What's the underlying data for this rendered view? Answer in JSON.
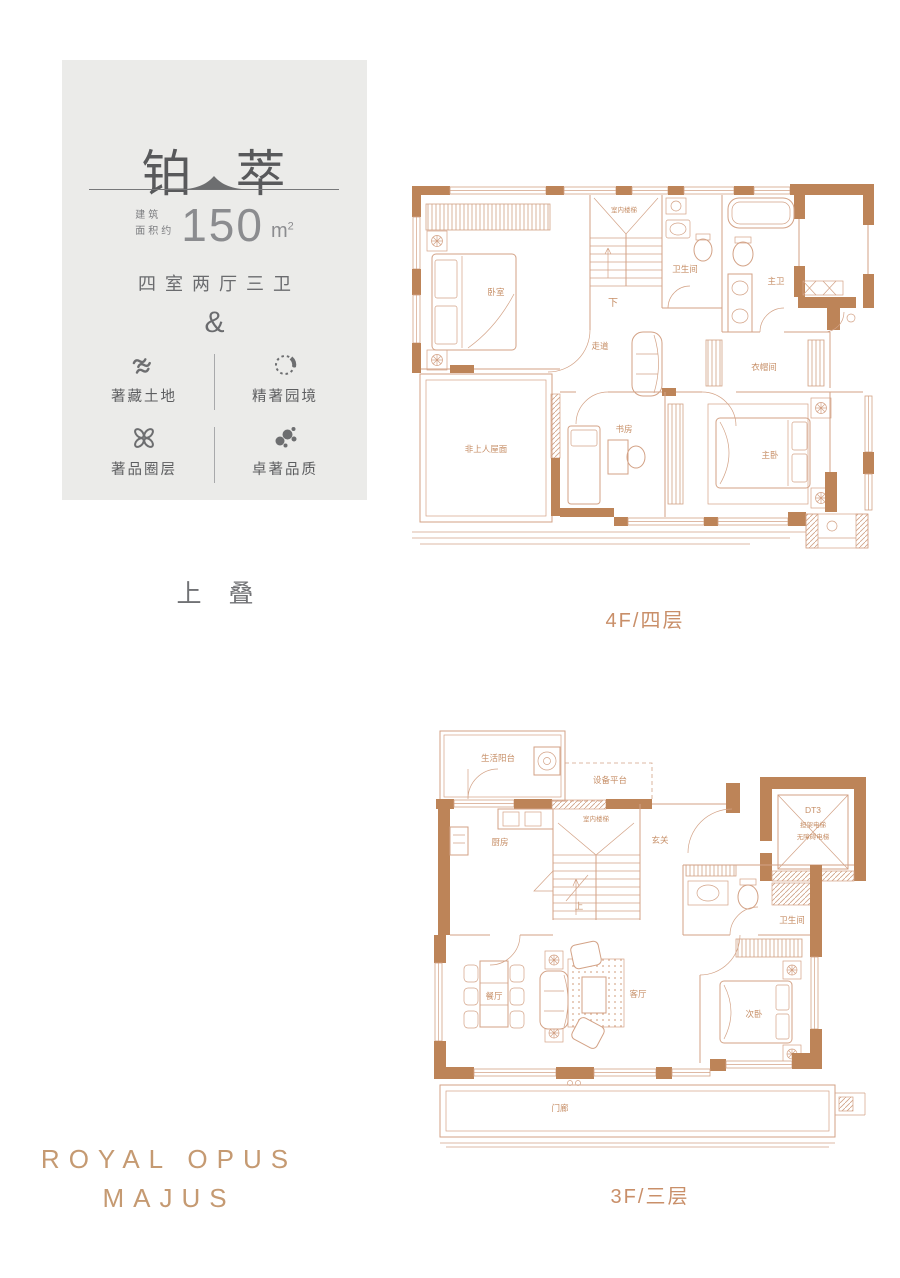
{
  "card": {
    "title": "铂 萃",
    "area_label_line1": "建筑",
    "area_label_line2": "面积约",
    "area_value": "150",
    "area_unit_base": "m",
    "area_unit_sup": "2",
    "layout": "四室两厅三卫",
    "ampersand": "&",
    "features": [
      {
        "icon": "land-waves-icon",
        "label": "著藏土地"
      },
      {
        "icon": "garden-circle-icon",
        "label": "精著园境"
      },
      {
        "icon": "knot-icon",
        "label": "著品圈层"
      },
      {
        "icon": "quality-dots-icon",
        "label": "卓著品质"
      }
    ]
  },
  "stack_label": "上 叠",
  "floor4": {
    "label": "4F/四层",
    "rooms": {
      "bedroom": "卧室",
      "stairs": "室内楼梯",
      "down": "下",
      "bath": "卫生间",
      "master_bath": "主卫",
      "corridor": "走道",
      "cloakroom": "衣帽间",
      "roof": "非上人屋面",
      "study": "书房",
      "master_bedroom": "主卧"
    }
  },
  "floor3": {
    "label": "3F/三层",
    "rooms": {
      "balcony": "生活阳台",
      "equipment": "设备平台",
      "stairs": "室内楼梯",
      "up": "上",
      "kitchen": "厨房",
      "foyer": "玄关",
      "elevator": "DT3",
      "elevator_note1": "担架电梯",
      "elevator_note2": "无障碍电梯",
      "bath": "卫生间",
      "dining": "餐厅",
      "living": "客厅",
      "second_bedroom": "次卧",
      "porch": "门廊"
    }
  },
  "brand": {
    "line1": "ROYAL OPUS",
    "line2": "MAJUS"
  },
  "colors": {
    "card_bg": "#ebebe9",
    "dark_text": "#58595b",
    "plan_line": "#d3a286",
    "wall_fill": "#bd8458",
    "plan_label": "#c68e66",
    "brand_text": "#c59a72"
  }
}
